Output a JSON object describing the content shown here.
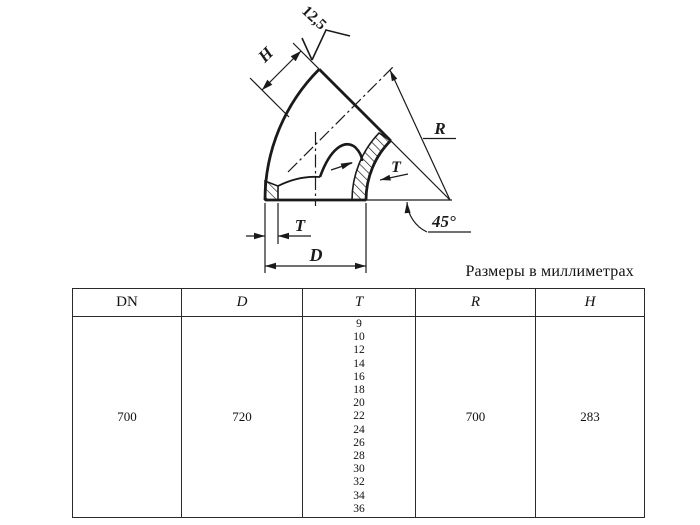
{
  "caption": "Размеры в миллиметрах",
  "drawing": {
    "roughness_label": "12,5",
    "h_label": "H",
    "r_label": "R",
    "t_label_section": "T",
    "t_label_bottom": "T",
    "d_label": "D",
    "angle_label": "45°"
  },
  "table": {
    "headers": [
      "DN",
      "D",
      "T",
      "R",
      "H"
    ],
    "row": {
      "dn": "700",
      "d": "720",
      "t_values": [
        "9",
        "10",
        "12",
        "14",
        "16",
        "18",
        "20",
        "22",
        "24",
        "26",
        "28",
        "30",
        "32",
        "34",
        "36"
      ],
      "r": "700",
      "h": "283"
    }
  },
  "colors": {
    "ink": "#1a1a1a",
    "background": "#ffffff"
  }
}
